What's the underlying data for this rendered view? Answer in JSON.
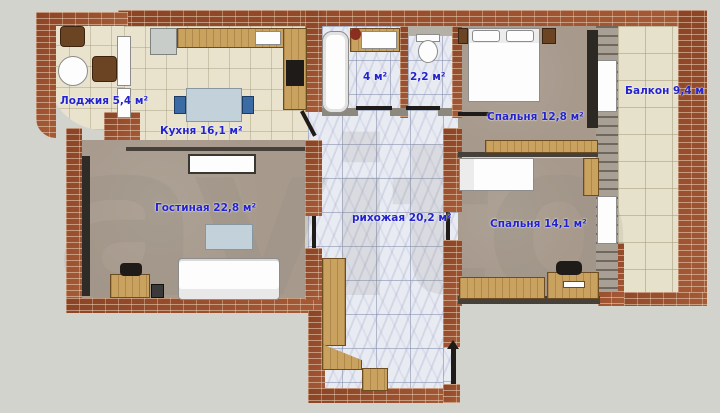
{
  "watermark": "avito",
  "rooms": {
    "loggia": {
      "label": "Лоджия 5,4 м²"
    },
    "kitchen": {
      "label": "Кухня 16,1 м²"
    },
    "living": {
      "label": "Гостиная 22,8 м²"
    },
    "bath": {
      "label": "4 м²"
    },
    "wc": {
      "label": "2,2 м²"
    },
    "bedroom1": {
      "label": "Спальня 12,8 м²"
    },
    "balcony": {
      "label": "Балкон 9,4 м"
    },
    "hallway": {
      "label": "рихожая 20,2 м²"
    },
    "bedroom2": {
      "label": "Спальня 14,1 м²"
    }
  },
  "colors": {
    "label_blue": "#2323cd",
    "brick": "#9c4e2d",
    "floor_tile": "#e9e3cd",
    "floor_marble": "#e9ebf3",
    "floor_carpet": "#a79a8d",
    "background": "#d3d3cd",
    "wood": "#c9a25f"
  }
}
